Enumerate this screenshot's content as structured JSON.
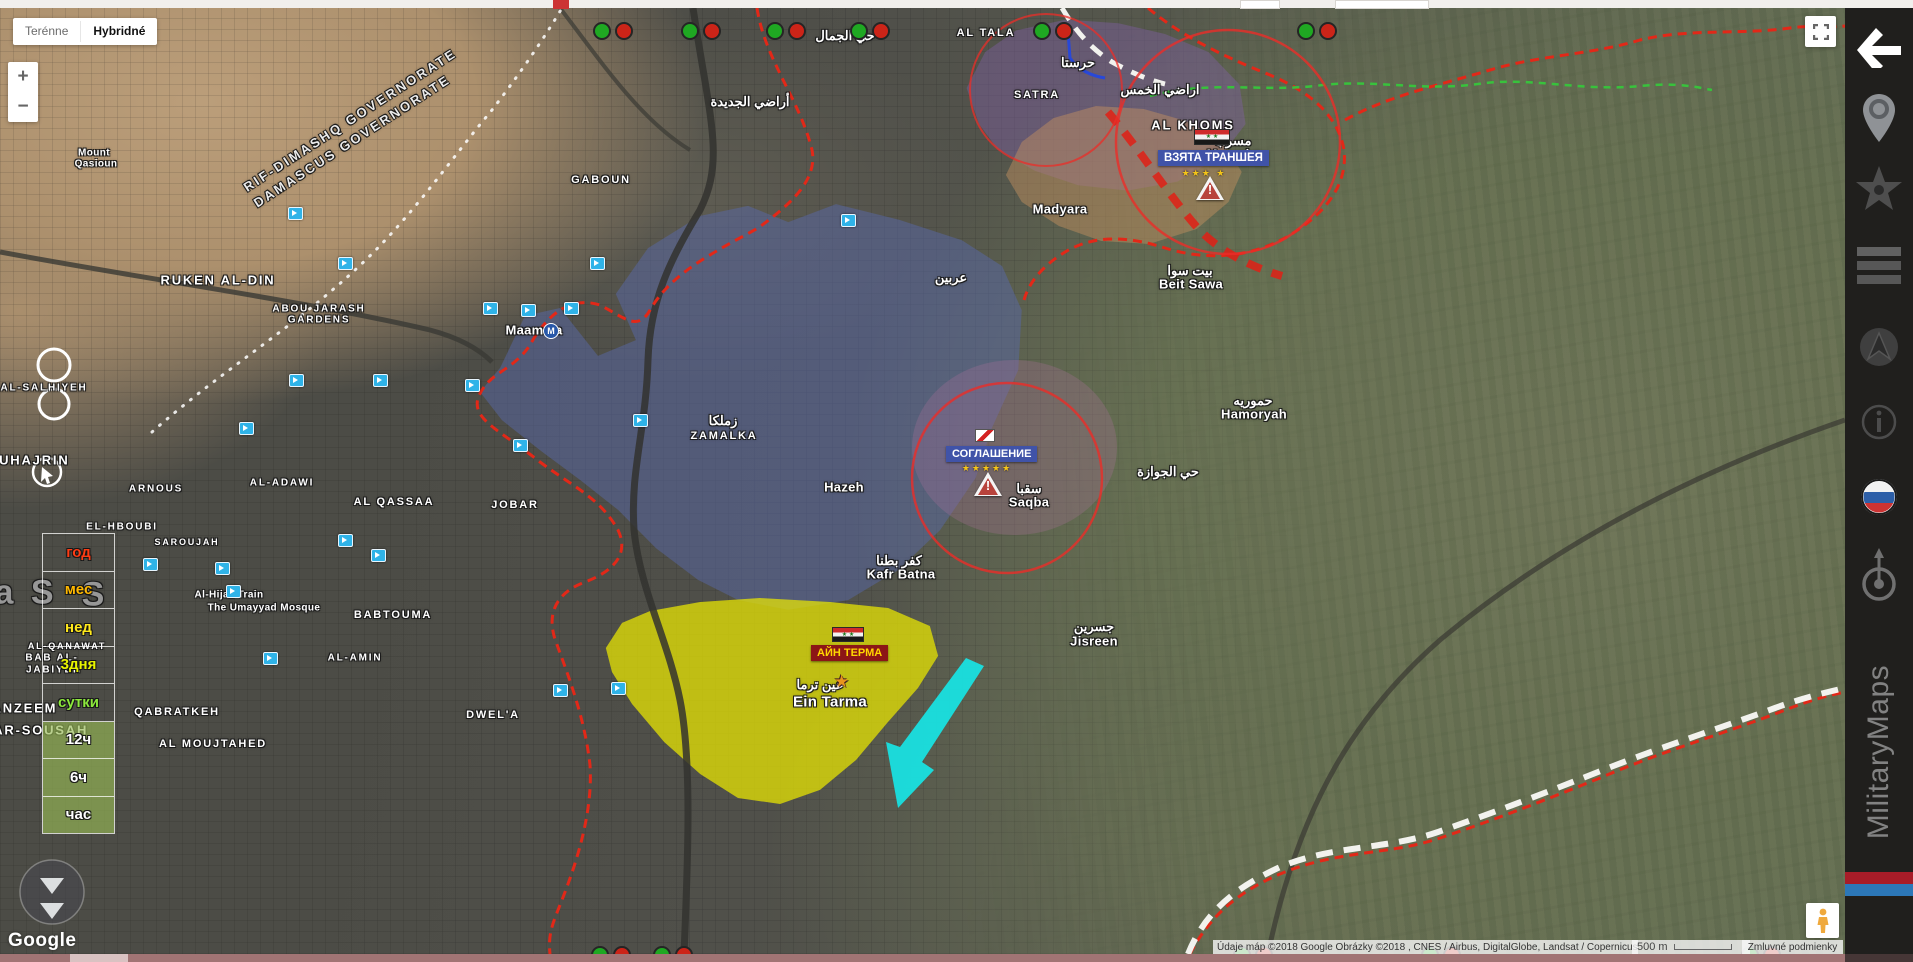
{
  "map_type_control": {
    "options": [
      {
        "label": "Terénne",
        "active": false
      },
      {
        "label": "Hybridné",
        "active": true
      }
    ]
  },
  "zoom_control": {
    "zoom_in": "+",
    "zoom_out": "−"
  },
  "google_logo": "Google",
  "attribution": {
    "text": "Údaje máp ©2018 Google Obrázky ©2018 , CNES / Airbus, DigitalGlobe, Landsat / Copernicus",
    "scale_label": "500 m",
    "terms_label": "Zmluvné podmienky"
  },
  "sidebar": {
    "brand": "MilitaryMaps",
    "icons": [
      "back-arrow",
      "location-pin",
      "star",
      "list",
      "navigation",
      "info",
      "russia-flag",
      "compass-target"
    ],
    "stripe_colors": [
      "#a81c28",
      "#2c77b8"
    ]
  },
  "time_filter": {
    "items": [
      {
        "label": "год",
        "color": "#ff3c14",
        "bg": ""
      },
      {
        "label": "мес",
        "color": "#ffb800",
        "bg": ""
      },
      {
        "label": "нед",
        "color": "#ffe81c",
        "bg": ""
      },
      {
        "label": "3дня",
        "color": "#e8f400",
        "bg": ""
      },
      {
        "label": "сутки",
        "color": "#8ce83c",
        "bg": ""
      },
      {
        "label": "12ч",
        "color": "#ffffff",
        "bg": "rgba(150,185,85,0.65)"
      },
      {
        "label": "6ч",
        "color": "#ffffff",
        "bg": "rgba(150,185,85,0.65)"
      },
      {
        "label": "час",
        "color": "#ffffff",
        "bg": "rgba(150,185,85,0.65)"
      }
    ]
  },
  "military": [
    {
      "text": "ВЗЯТА ТРАНШЕЯ",
      "stars": "★★★ ★",
      "flag": "syria-flag",
      "box_color": "#4053a8",
      "text_color": "#ffffff"
    },
    {
      "text": "СОГЛАШЕНИЕ",
      "stars": "★★★★★",
      "flag": "truce-flag",
      "box_color": "#4053a8",
      "text_color": "#ffffff"
    },
    {
      "text": "АЙН ТЕРМА",
      "stars": "",
      "flag": "syria-flag",
      "box_color": "#8c1616",
      "text_color": "#ffd700"
    }
  ],
  "flags": {
    "syria_stars": "★ ★"
  },
  "map": {
    "zones": [
      {
        "name": "zone-blue",
        "color": "rgba(88,104,168,0.5)"
      },
      {
        "name": "zone-purple",
        "color": "rgba(128,96,168,0.42)"
      },
      {
        "name": "zone-tan",
        "color": "rgba(200,146,96,0.45)"
      },
      {
        "name": "zone-midpurple",
        "color": "rgba(168,112,152,0.3)"
      },
      {
        "name": "zone-yellow",
        "color": "rgba(235,233,0,0.72)"
      }
    ],
    "line_colors": {
      "front_red": "#e22818",
      "truce_white": "#f2f2ee",
      "green_dashed": "#38c23c",
      "blue_line": "#2848d8",
      "cyan_arrow": "#19e0e0"
    },
    "metro_label": "M",
    "place_labels": [
      {
        "type": "rot",
        "text": "RIF-DIMASHQ GOVERNORATE",
        "x": 350,
        "y": 112,
        "rot": -33
      },
      {
        "type": "rot",
        "text": "DAMASCUS GOVERNORATE",
        "x": 352,
        "y": 133,
        "rot": -33
      },
      {
        "type": "d",
        "text": "RUKEN AL-DIN",
        "x": 218,
        "y": 272,
        "size": 13
      },
      {
        "type": "d",
        "text": "ABOU JARASH",
        "x": 319,
        "y": 301,
        "size": 10
      },
      {
        "type": "d",
        "text": "GARDENS",
        "x": 319,
        "y": 312,
        "size": 10
      },
      {
        "type": "d",
        "text": "AL-SALHIYEH",
        "x": 44,
        "y": 380,
        "size": 10
      },
      {
        "type": "d",
        "text": "GABOUN",
        "x": 601,
        "y": 172,
        "size": 11
      },
      {
        "type": "d",
        "text": "AL QASSAA",
        "x": 394,
        "y": 494,
        "size": 11
      },
      {
        "type": "d",
        "text": "AL-ADAWI",
        "x": 282,
        "y": 475,
        "size": 10
      },
      {
        "type": "d",
        "text": "ARNOUS",
        "x": 156,
        "y": 481,
        "size": 10
      },
      {
        "type": "d",
        "text": "EL-HBOUBI",
        "x": 122,
        "y": 519,
        "size": 10
      },
      {
        "type": "d",
        "text": "SAROUJAH",
        "x": 187,
        "y": 534,
        "size": 9
      },
      {
        "type": "d",
        "text": "MUHAJRIN",
        "x": 28,
        "y": 452,
        "size": 13
      },
      {
        "type": "d",
        "text": "BABTOUMA",
        "x": 393,
        "y": 607,
        "size": 11
      },
      {
        "type": "d",
        "text": "AL-AMIN",
        "x": 355,
        "y": 650,
        "size": 10
      },
      {
        "type": "d",
        "text": "AL-QANAWAT",
        "x": 67,
        "y": 638,
        "size": 9
      },
      {
        "type": "d",
        "text": "BAB AL-",
        "x": 52,
        "y": 650,
        "size": 10
      },
      {
        "type": "d",
        "text": "JABIYEH",
        "x": 54,
        "y": 662,
        "size": 10
      },
      {
        "type": "d",
        "text": "QABRATKEH",
        "x": 177,
        "y": 704,
        "size": 11
      },
      {
        "type": "d",
        "text": "AL MOUJTAHED",
        "x": 213,
        "y": 736,
        "size": 11
      },
      {
        "type": "d",
        "text": "TANZEEM",
        "x": 20,
        "y": 700,
        "size": 13
      },
      {
        "type": "d",
        "text": "KAFAR-SOUSAH",
        "x": 25,
        "y": 722,
        "size": 13
      },
      {
        "type": "d",
        "text": "BASATIN AL SOUK EL MIDAN",
        "x": 205,
        "y": 954,
        "size": 13
      },
      {
        "type": "d",
        "text": "BOSTAN ADDOUR",
        "x": 673,
        "y": 956,
        "size": 12
      },
      {
        "type": "d",
        "text": "DWEL'A",
        "x": 493,
        "y": 707,
        "size": 11
      },
      {
        "type": "d",
        "text": "JOBAR",
        "x": 515,
        "y": 497,
        "size": 11
      },
      {
        "type": "d",
        "text": "ZAMALKA",
        "x": 724,
        "y": 428,
        "size": 11
      },
      {
        "type": "d",
        "text": "SATRA",
        "x": 1037,
        "y": 87,
        "size": 11
      },
      {
        "type": "d",
        "text": "AL TALA",
        "x": 986,
        "y": 25,
        "size": 11
      },
      {
        "type": "d",
        "text": "AL KHOMS",
        "x": 1193,
        "y": 117,
        "size": 13
      },
      {
        "type": "t",
        "text": "Hazeh",
        "x": 844,
        "y": 479
      },
      {
        "type": "t",
        "text": "Ein Tarma",
        "x": 830,
        "y": 694,
        "size": 15
      },
      {
        "type": "t",
        "text": "Kafr Batna",
        "x": 901,
        "y": 566
      },
      {
        "type": "t",
        "text": "Saqba",
        "x": 1029,
        "y": 494
      },
      {
        "type": "t",
        "text": "Jisreen",
        "x": 1094,
        "y": 633
      },
      {
        "type": "t",
        "text": "Beit Sawa",
        "x": 1191,
        "y": 276
      },
      {
        "type": "t",
        "text": "Hamoryah",
        "x": 1254,
        "y": 406
      },
      {
        "type": "t",
        "text": "Mesraba",
        "x": 1234,
        "y": 146
      },
      {
        "type": "t",
        "text": "Madyara",
        "x": 1060,
        "y": 201
      },
      {
        "type": "t",
        "text": "Maamala",
        "x": 534,
        "y": 322
      },
      {
        "type": "s",
        "text": "Mount",
        "x": 94,
        "y": 145
      },
      {
        "type": "s",
        "text": "Qasioun",
        "x": 96,
        "y": 156
      },
      {
        "type": "s",
        "text": "The Umayyad Mosque",
        "x": 264,
        "y": 600
      },
      {
        "type": "s",
        "text": "Al-Hijaz Train",
        "x": 229,
        "y": 587
      },
      {
        "type": "a",
        "text": "أراضي الجديدة",
        "x": 750,
        "y": 94
      },
      {
        "type": "a",
        "text": "اراضي الخمس",
        "x": 1160,
        "y": 82
      },
      {
        "type": "a",
        "text": "حرستا",
        "x": 1078,
        "y": 55
      },
      {
        "type": "a",
        "text": "حي الجوازة",
        "x": 1168,
        "y": 464
      },
      {
        "type": "a",
        "text": "عربين",
        "x": 951,
        "y": 270
      },
      {
        "type": "a",
        "text": "زملكا",
        "x": 723,
        "y": 413
      },
      {
        "type": "a",
        "text": "عين ترما",
        "x": 820,
        "y": 677
      },
      {
        "type": "a",
        "text": "سقبا",
        "x": 1029,
        "y": 481
      },
      {
        "type": "a",
        "text": "كفر بطنا",
        "x": 899,
        "y": 553
      },
      {
        "type": "a",
        "text": "جسرين",
        "x": 1094,
        "y": 619
      },
      {
        "type": "a",
        "text": "بيت سوا",
        "x": 1190,
        "y": 263
      },
      {
        "type": "a",
        "text": "حموريه",
        "x": 1253,
        "y": 393
      },
      {
        "type": "a",
        "text": "مسرابا",
        "x": 1233,
        "y": 133
      },
      {
        "type": "a",
        "text": "حي الجمال",
        "x": 845,
        "y": 28
      },
      {
        "type": "f",
        "text": "a S",
        "x": 26,
        "y": 585
      },
      {
        "type": "f",
        "text": "S",
        "x": 95,
        "y": 587
      }
    ],
    "camera_markers": [
      [
        295,
        205
      ],
      [
        345,
        255
      ],
      [
        490,
        300
      ],
      [
        528,
        302
      ],
      [
        571,
        300
      ],
      [
        597,
        255
      ],
      [
        472,
        377
      ],
      [
        380,
        372
      ],
      [
        296,
        372
      ],
      [
        246,
        420
      ],
      [
        222,
        560
      ],
      [
        150,
        556
      ],
      [
        345,
        532
      ],
      [
        520,
        437
      ],
      [
        640,
        412
      ],
      [
        378,
        547
      ],
      [
        270,
        650
      ],
      [
        233,
        583
      ],
      [
        560,
        682
      ],
      [
        618,
        680
      ],
      [
        848,
        212
      ]
    ],
    "status_dot_pairs": {
      "top_y": 21,
      "top_x": [
        600,
        688,
        773,
        857,
        1040,
        1304
      ],
      "bottom_y": 945,
      "bottom_x": [
        598,
        660,
        1240,
        1428,
        1748
      ]
    }
  }
}
